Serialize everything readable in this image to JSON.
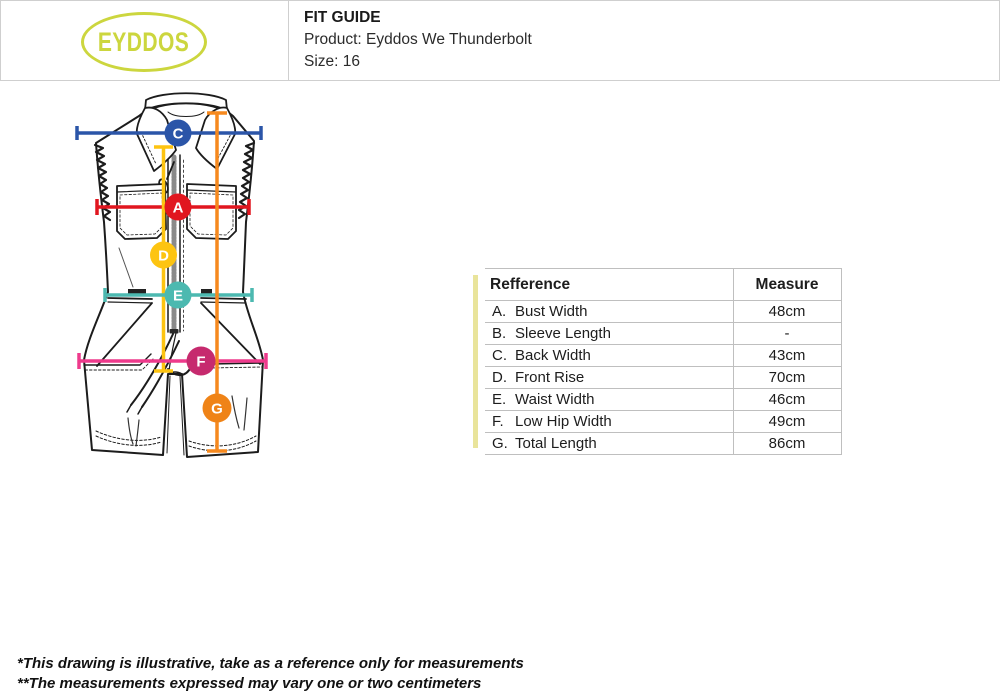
{
  "header": {
    "logo": "EYDDOS",
    "title": "FIT GUIDE",
    "product": "Product: Eyddos We Thunderbolt",
    "size": "Size: 16"
  },
  "table": {
    "columns": {
      "reference": "Refference",
      "measure": "Measure"
    },
    "rows": [
      {
        "ref": "A.",
        "label": "Bust Width",
        "measure": "48cm"
      },
      {
        "ref": "B.",
        "label": "Sleeve Length",
        "measure": "-"
      },
      {
        "ref": "C.",
        "label": "Back Width",
        "measure": "43cm"
      },
      {
        "ref": "D.",
        "label": "Front Rise",
        "measure": "70cm"
      },
      {
        "ref": "E.",
        "label": "Waist Width",
        "measure": "46cm"
      },
      {
        "ref": "F.",
        "label": "Low Hip Width",
        "measure": "49cm"
      },
      {
        "ref": "G.",
        "label": "Total Length",
        "measure": "86cm"
      }
    ]
  },
  "markers": {
    "a": "A",
    "c": "C",
    "d": "D",
    "e": "E",
    "f": "F",
    "g": "G"
  },
  "notes": {
    "line1": "*This drawing is illustrative, take as a reference only for measurements",
    "line2": "**The measurements expressed may vary one or two centimeters"
  },
  "colors": {
    "logo_green": "#ccd63e",
    "accent_bar": "#e9e49b",
    "blue": "#2b55a8",
    "red": "#e1161f",
    "yellow": "#fdc411",
    "teal": "#4cb9b0",
    "pink_line": "#ee3a8c",
    "pink_circle": "#c62a6e",
    "orange_line": "#f6891e",
    "orange_circle": "#ef8317"
  }
}
